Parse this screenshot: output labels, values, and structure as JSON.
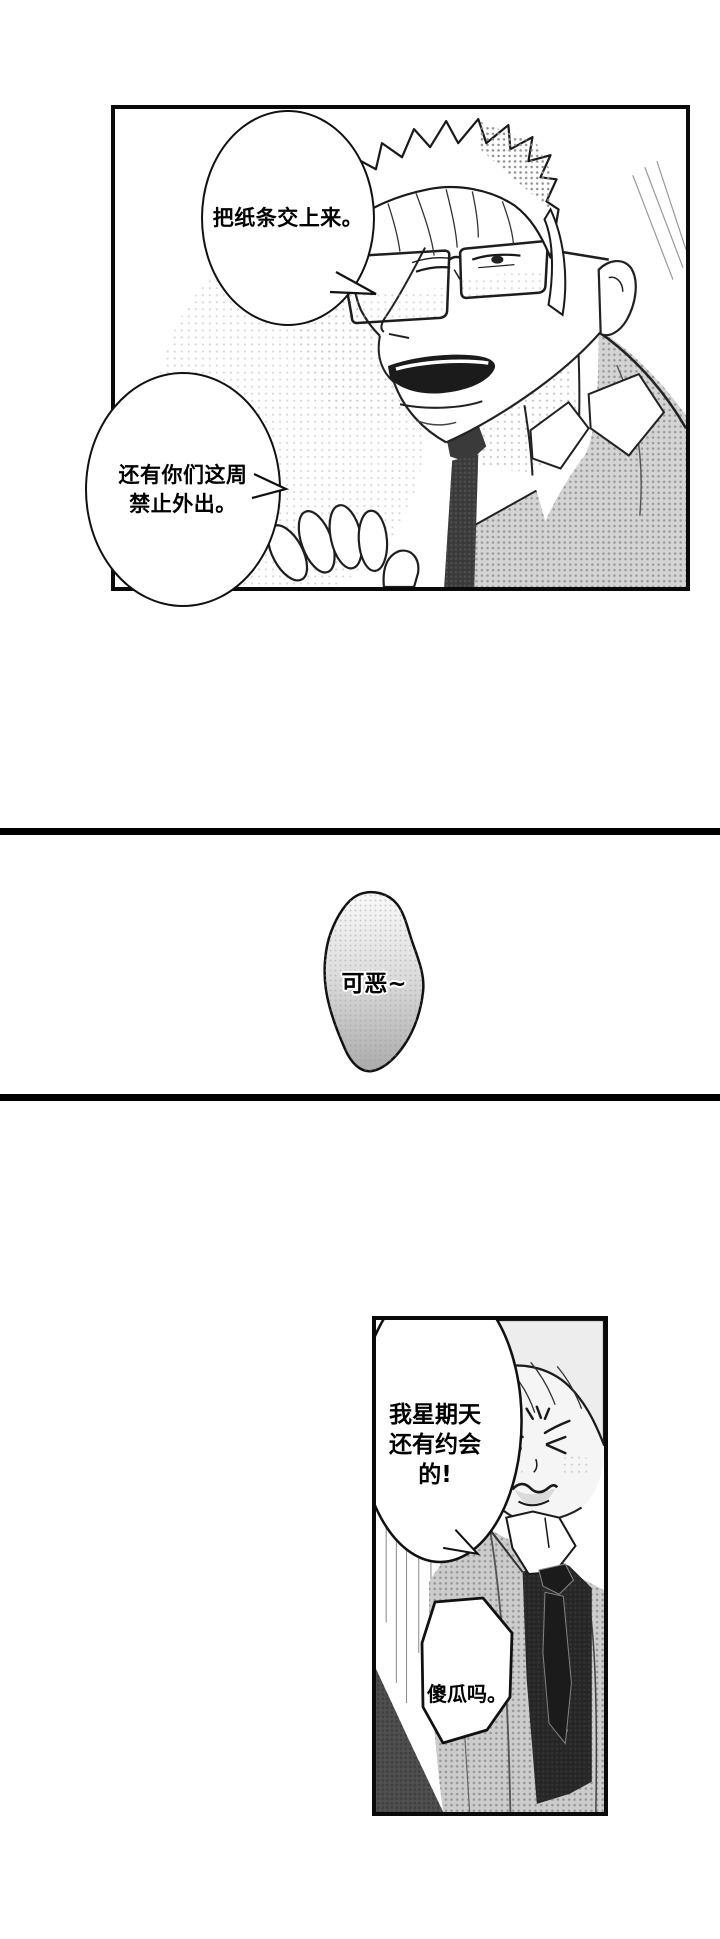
{
  "page": {
    "kind": "manga page",
    "width_px": 720,
    "height_px": 1939,
    "background": "#ffffff",
    "ink_color": "#0f0f0f",
    "halftone_gray": "#8f8f8f",
    "vest_dark": "#262626"
  },
  "panel_teacher": {
    "alt": "Close-up of a stern bespectacled man in a suit and tie raising his hand",
    "bubble_hand_over_note": {
      "line1": "把纸条交上来。"
    },
    "bubble_grounded": {
      "line1": "还有你们这周",
      "line2": "禁止外出。"
    }
  },
  "interlude": {
    "grumble_text": "可恶~"
  },
  "panel_student": {
    "alt": "Young man grimacing with eyes squeezed shut, in shirt, tie and dark vest",
    "bubble_date": {
      "line1": "我星期天",
      "line2": "还有约会",
      "line3": "的!"
    },
    "bubble_idiot": {
      "line1": "傻瓜吗。"
    }
  },
  "dividers": {
    "color": "#000000",
    "count": 2
  }
}
